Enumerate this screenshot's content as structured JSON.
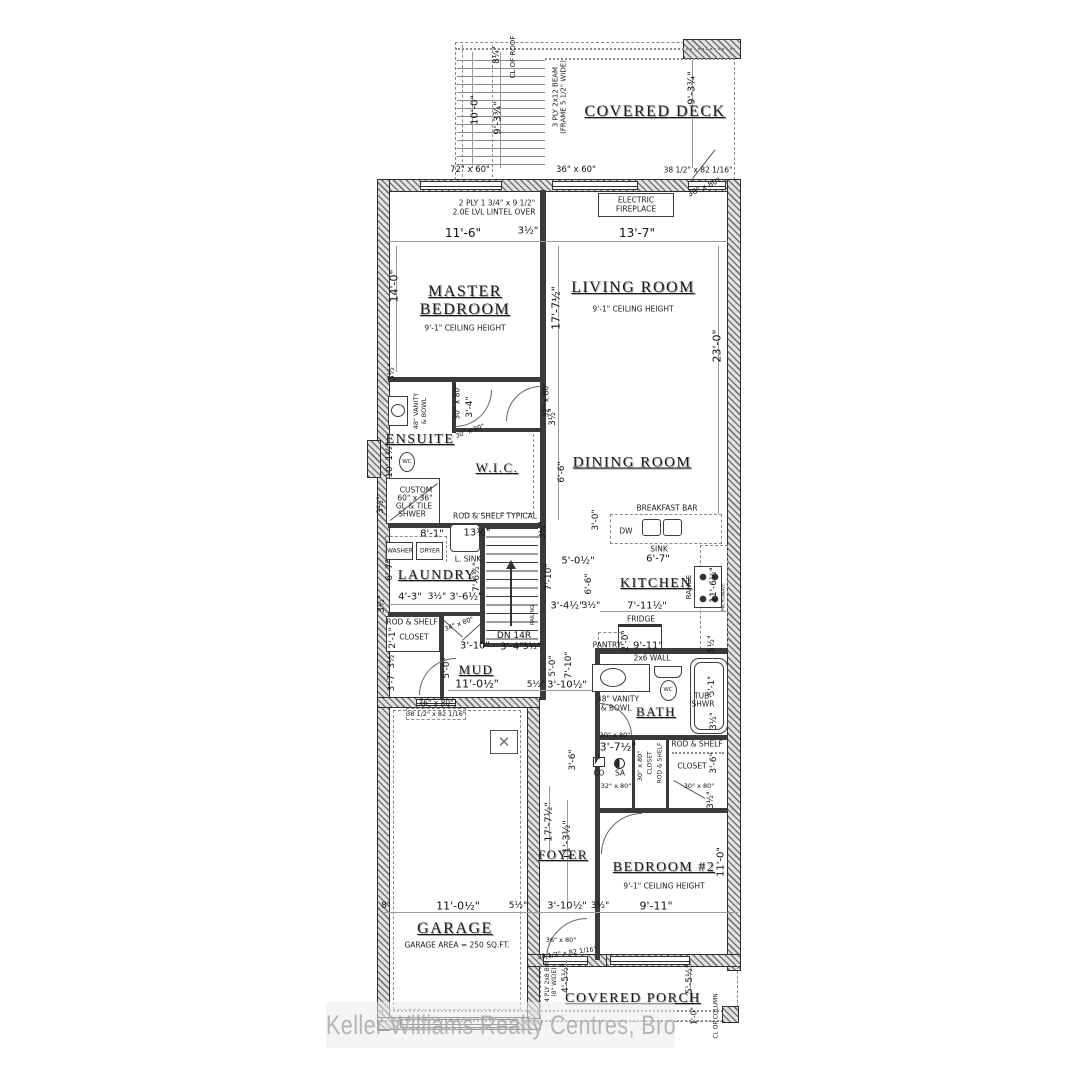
{
  "watermark": "Keller Williams Realty Centres, Brokerage",
  "rooms": {
    "covered_deck": "COVERED DECK",
    "master_1": "MASTER",
    "master_2": "BEDROOM",
    "living": "LIVING ROOM",
    "ensuite": "ENSUITE",
    "wic": "W.I.C.",
    "dining": "DINING ROOM",
    "laundry": "LAUNDRY",
    "kitchen": "KITCHEN",
    "mud": "MUD",
    "bath": "BATH",
    "foyer": "FOYER",
    "bedroom2": "BEDROOM #2",
    "garage": "GARAGE",
    "covered_porch": "COVERED PORCH"
  },
  "subs": {
    "ceiling": "9'-1\" CEILING HEIGHT",
    "garage_area": "GARAGE AREA = 250 SQ.FT."
  },
  "fixtures": {
    "fireplace_1": "ELECTRIC",
    "fireplace_2": "FIREPLACE",
    "washer": "WASHER",
    "dryer": "DRYER",
    "lsink": "L. SINK",
    "breakfast_bar": "BREAKFAST BAR",
    "dw": "DW",
    "sink": "SINK",
    "fridge": "FRIDGE",
    "range": "RANGE",
    "pantry": "PANTRY",
    "microwave": "MICROWAVE",
    "wc": "WC",
    "vanity_1": "48\" VANITY",
    "vanity_2": "& BOWL",
    "tub_1": "TUB-",
    "tub_2": "SHWR",
    "rod_shelf": "ROD & SHELF",
    "rod_shelf_typical": "ROD & SHELF TYPICAL",
    "closet": "CLOSET",
    "railing": "RAILING",
    "dn": "DN 14R",
    "co": "CO",
    "sa": "SA",
    "wall_2x6": "2x6 WALL"
  },
  "notes": {
    "lintel_1": "2 PLY 1 3/4\" x 9 1/2\"",
    "lintel_2": "2.0E LVL LINTEL OVER",
    "deck_beam_1": "3 PLY 2x12 BEAM",
    "deck_beam_2": "(FRAME 5 1/2\" WIDE)",
    "roof_cl": "CL OF ROOF",
    "column_cl": "CL OF COLUMN",
    "porch_beam_1": "4 PLY 2x8 BM",
    "porch_beam_2": "(8\" WIDE)",
    "shower_1": "CUSTOM",
    "shower_2": "60\" x 36\"",
    "shower_3": "GL & TILE",
    "shower_4": "SHWER"
  },
  "dims": [
    "11'-6\"",
    "3½\"",
    "13'-7\"",
    "14'-0\"",
    "17'-7½\"",
    "23'-0\"",
    "3½\"",
    "10'-0\"",
    "9'-3¾\"",
    "8¼\"",
    "9'-3¾\"",
    "72\" x 60\"",
    "36\" x 60\"",
    "38 1/2\" x 82 1/16\"",
    "36\" x 80\"",
    "30\" x 80\"",
    "3'-4\"",
    "10'-1½\"",
    "3½\"",
    "32\" x 80\"",
    "3½\"",
    "6'-6\"",
    "30\" x 80\"",
    "8'-1\"",
    "13½\"",
    "6'-7\"",
    "7'-6½\"",
    "4'-3\"",
    "3½\"",
    "3'-6½\"",
    "3½\"",
    "2'-1\"",
    "34\" x 80\"",
    "3'-10\"",
    "3'-4\"",
    "3½\"",
    "3½\"",
    "5'-0½\"",
    "7'-10\"",
    "6'-6\"",
    "3'-4½\"",
    "3½\"",
    "3'-0\"",
    "6'-7\"",
    "7'-11½\"",
    "11'-6½\"",
    "9'-11\"",
    "2'-0\"",
    "5½\"",
    "5'-0\"",
    "11'-0½\"",
    "5½\"",
    "3'-10½\"",
    "5'-0\"",
    "7'-10\"",
    "3'-7\" 3½\"",
    "36\" x 80\"",
    "38 1/2\" x 82 1/16\"",
    "5'-1\"",
    "3½\"",
    "3'-7½\"",
    "30\" x 80\"",
    "3'-6\"",
    "3'-6\"",
    "32\" x 80\"",
    "30\" x 80\"",
    "3½\"",
    "30\" x 80\"",
    "17'-7½\"",
    "11'-3½\"",
    "11'-0\"",
    "8\"",
    "11'-0½\"",
    "5½\"",
    "3'-10½\"",
    "3½\"",
    "9'-11\"",
    "36\" x 80\"",
    "38 1/2\" x 82 1/16\"",
    "4'-5½\"",
    "5'-5½\"",
    "1'-0\""
  ]
}
